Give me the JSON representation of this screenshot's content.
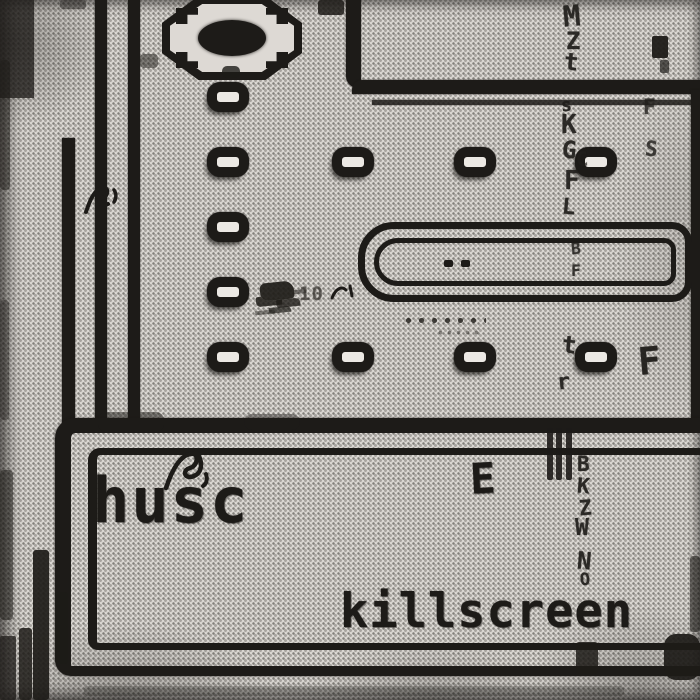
{
  "artwork": {
    "artist_name": "husc",
    "album_title": "killscreen",
    "score_popup": "10",
    "box_glyph": "E",
    "style": "black-and-white halftone photocopy dither",
    "scene": "arcade maze killscreen with pellet grid, wall corridors and octagon ornament"
  },
  "palette": {
    "paper": "#d9d6d1",
    "ink": "#1d1b18",
    "halftone_dot": "#3c3a36",
    "pellet_hole": "#ece9e4"
  },
  "glyph_column": {
    "description": "distressed vertical strip of broken letters running down the right-center",
    "letters": [
      {
        "ch": "M",
        "x": 563,
        "y": 2,
        "s": 29
      },
      {
        "ch": "Z",
        "x": 566,
        "y": 29,
        "s": 24
      },
      {
        "ch": "t",
        "x": 564,
        "y": 50,
        "s": 24
      },
      {
        "ch": "s",
        "x": 561,
        "y": 97,
        "s": 18
      },
      {
        "ch": "K",
        "x": 561,
        "y": 112,
        "s": 26
      },
      {
        "ch": "G",
        "x": 562,
        "y": 138,
        "s": 24
      },
      {
        "ch": "C",
        "x": 576,
        "y": 149,
        "s": 20,
        "o": 0.7
      },
      {
        "ch": "F",
        "x": 564,
        "y": 168,
        "s": 26
      },
      {
        "ch": "L",
        "x": 562,
        "y": 197,
        "s": 22
      },
      {
        "ch": "B",
        "x": 571,
        "y": 241,
        "s": 16,
        "o": 0.85
      },
      {
        "ch": "F",
        "x": 571,
        "y": 263,
        "s": 16,
        "o": 0.85
      },
      {
        "ch": "t",
        "x": 562,
        "y": 333,
        "s": 24
      },
      {
        "ch": "r",
        "x": 557,
        "y": 372,
        "s": 22
      },
      {
        "ch": "B",
        "x": 577,
        "y": 454,
        "s": 21
      },
      {
        "ch": "K",
        "x": 577,
        "y": 476,
        "s": 21
      },
      {
        "ch": "Z",
        "x": 579,
        "y": 498,
        "s": 21
      },
      {
        "ch": "W",
        "x": 575,
        "y": 517,
        "s": 23
      },
      {
        "ch": "N",
        "x": 577,
        "y": 549,
        "s": 24
      },
      {
        "ch": "O",
        "x": 580,
        "y": 572,
        "s": 17
      },
      {
        "ch": "F",
        "x": 643,
        "y": 97,
        "s": 21,
        "o": 0.8
      },
      {
        "ch": "S",
        "x": 645,
        "y": 139,
        "s": 21,
        "o": 0.8
      },
      {
        "ch": "F",
        "x": 638,
        "y": 342,
        "s": 38,
        "o": 0.95
      }
    ]
  },
  "maze": {
    "pellets": [
      {
        "cx": 228,
        "cy": 97
      },
      {
        "cx": 228,
        "cy": 162
      },
      {
        "cx": 228,
        "cy": 227
      },
      {
        "cx": 228,
        "cy": 292
      },
      {
        "cx": 228,
        "cy": 357
      },
      {
        "cx": 353,
        "cy": 162
      },
      {
        "cx": 353,
        "cy": 357
      },
      {
        "cx": 475,
        "cy": 162
      },
      {
        "cx": 475,
        "cy": 357
      },
      {
        "cx": 596,
        "cy": 162
      },
      {
        "cx": 596,
        "cy": 357
      }
    ],
    "pill_dots": [
      {
        "x": 444,
        "y": 260
      },
      {
        "x": 461,
        "y": 260
      }
    ],
    "trails": [
      {
        "x": 402,
        "y": 316,
        "w": 84,
        "h": 9,
        "o": 0.9,
        "dot": 2.3,
        "sx": 13,
        "sy": 9
      },
      {
        "x": 436,
        "y": 329,
        "w": 46,
        "h": 12,
        "o": 0.5,
        "dot": 1.6,
        "sx": 9,
        "sy": 7
      }
    ],
    "blobs": [
      {
        "x": 0,
        "y": 0,
        "w": 34,
        "h": 98,
        "o": 0.78,
        "r": 0
      },
      {
        "x": 0,
        "y": 60,
        "w": 10,
        "h": 130,
        "o": 0.5,
        "r": 4
      },
      {
        "x": 0,
        "y": 300,
        "w": 9,
        "h": 120,
        "o": 0.4,
        "r": 4
      },
      {
        "x": 0,
        "y": 470,
        "w": 13,
        "h": 150,
        "o": 0.55,
        "r": 4
      },
      {
        "x": 0,
        "y": 636,
        "w": 16,
        "h": 64,
        "o": 0.75,
        "r": 2
      },
      {
        "x": 60,
        "y": 0,
        "w": 26,
        "h": 9,
        "o": 0.45,
        "r": 3
      },
      {
        "x": 318,
        "y": 0,
        "w": 26,
        "h": 15,
        "o": 0.85,
        "r": 3
      },
      {
        "x": 140,
        "y": 54,
        "w": 18,
        "h": 14,
        "o": 0.5,
        "r": 4
      },
      {
        "x": 652,
        "y": 36,
        "w": 16,
        "h": 22,
        "o": 0.95,
        "r": 2
      },
      {
        "x": 660,
        "y": 60,
        "w": 9,
        "h": 13,
        "o": 0.7,
        "r": 2
      },
      {
        "x": 222,
        "y": 66,
        "w": 18,
        "h": 12,
        "o": 0.8,
        "r": 5
      },
      {
        "x": 547,
        "y": 428,
        "w": 6,
        "h": 52,
        "o": 0.9,
        "r": 2
      },
      {
        "x": 556,
        "y": 428,
        "w": 6,
        "h": 52,
        "o": 0.9,
        "r": 2
      },
      {
        "x": 566,
        "y": 428,
        "w": 6,
        "h": 52,
        "o": 0.9,
        "r": 2
      },
      {
        "x": 98,
        "y": 412,
        "w": 66,
        "h": 20,
        "o": 0.5,
        "r": 8
      },
      {
        "x": 244,
        "y": 414,
        "w": 56,
        "h": 16,
        "o": 0.4,
        "r": 8
      },
      {
        "x": 33,
        "y": 550,
        "w": 16,
        "h": 150,
        "o": 0.92,
        "r": 3
      },
      {
        "x": 19,
        "y": 628,
        "w": 13,
        "h": 72,
        "o": 0.85,
        "r": 3
      },
      {
        "x": 55,
        "y": 592,
        "w": 13,
        "h": 72,
        "o": 0.8,
        "r": 3
      },
      {
        "x": 576,
        "y": 642,
        "w": 22,
        "h": 32,
        "o": 0.85,
        "r": 3
      },
      {
        "x": 664,
        "y": 634,
        "w": 36,
        "h": 46,
        "o": 0.92,
        "r": 12
      },
      {
        "x": 690,
        "y": 556,
        "w": 10,
        "h": 76,
        "o": 0.6,
        "r": 3
      },
      {
        "x": 84,
        "y": 686,
        "w": 540,
        "h": 10,
        "o": 0.25,
        "r": 4
      }
    ]
  }
}
